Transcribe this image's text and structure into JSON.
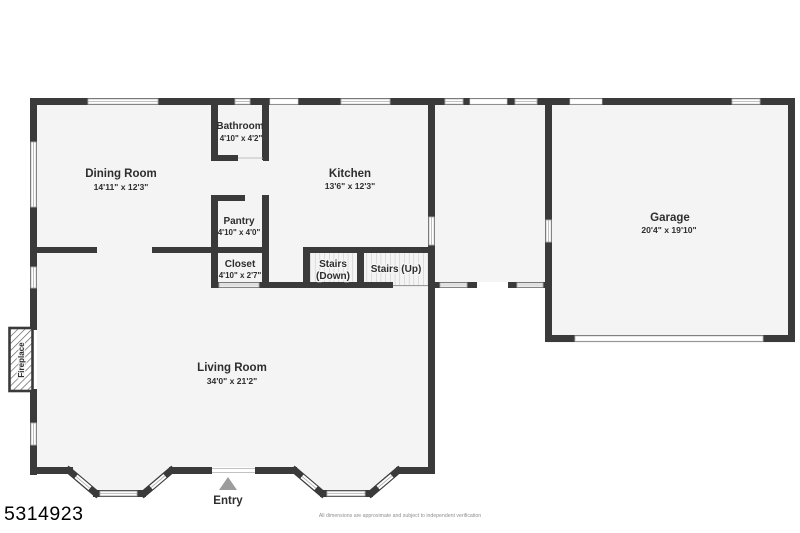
{
  "plan": {
    "rooms": [
      {
        "name": "Dining Room",
        "dims": "14'11\" x 12'3\""
      },
      {
        "name": "Bathroom",
        "dims": "4'10\" x 4'2\""
      },
      {
        "name": "Kitchen",
        "dims": "13'6\" x 12'3\""
      },
      {
        "name": "Pantry",
        "dims": "4'10\" x 4'0\""
      },
      {
        "name": "Closet",
        "dims": "4'10\" x 2'7\""
      },
      {
        "name": "Garage",
        "dims": "20'4\" x 19'10\""
      },
      {
        "name": "Living Room",
        "dims": "34'0\" x 21'2\""
      }
    ],
    "stairs_down_line1": "Stairs",
    "stairs_down_line2": "(Down)",
    "stairs_up": "Stairs (Up)",
    "fireplace_label": "Fireplace",
    "entry_label": "Entry"
  },
  "footer": {
    "listing_id": "5314923",
    "disclaimer": "All dimensions are approximate and subject to independent verification"
  },
  "colors": {
    "wall": "#3a3a3a",
    "floor": "#f4f4f4",
    "window_frame": "#adadad",
    "stair_tread": "#c4c4c4",
    "entry_arrow": "#9c9c9c",
    "label_text": "#2e2e2e"
  }
}
